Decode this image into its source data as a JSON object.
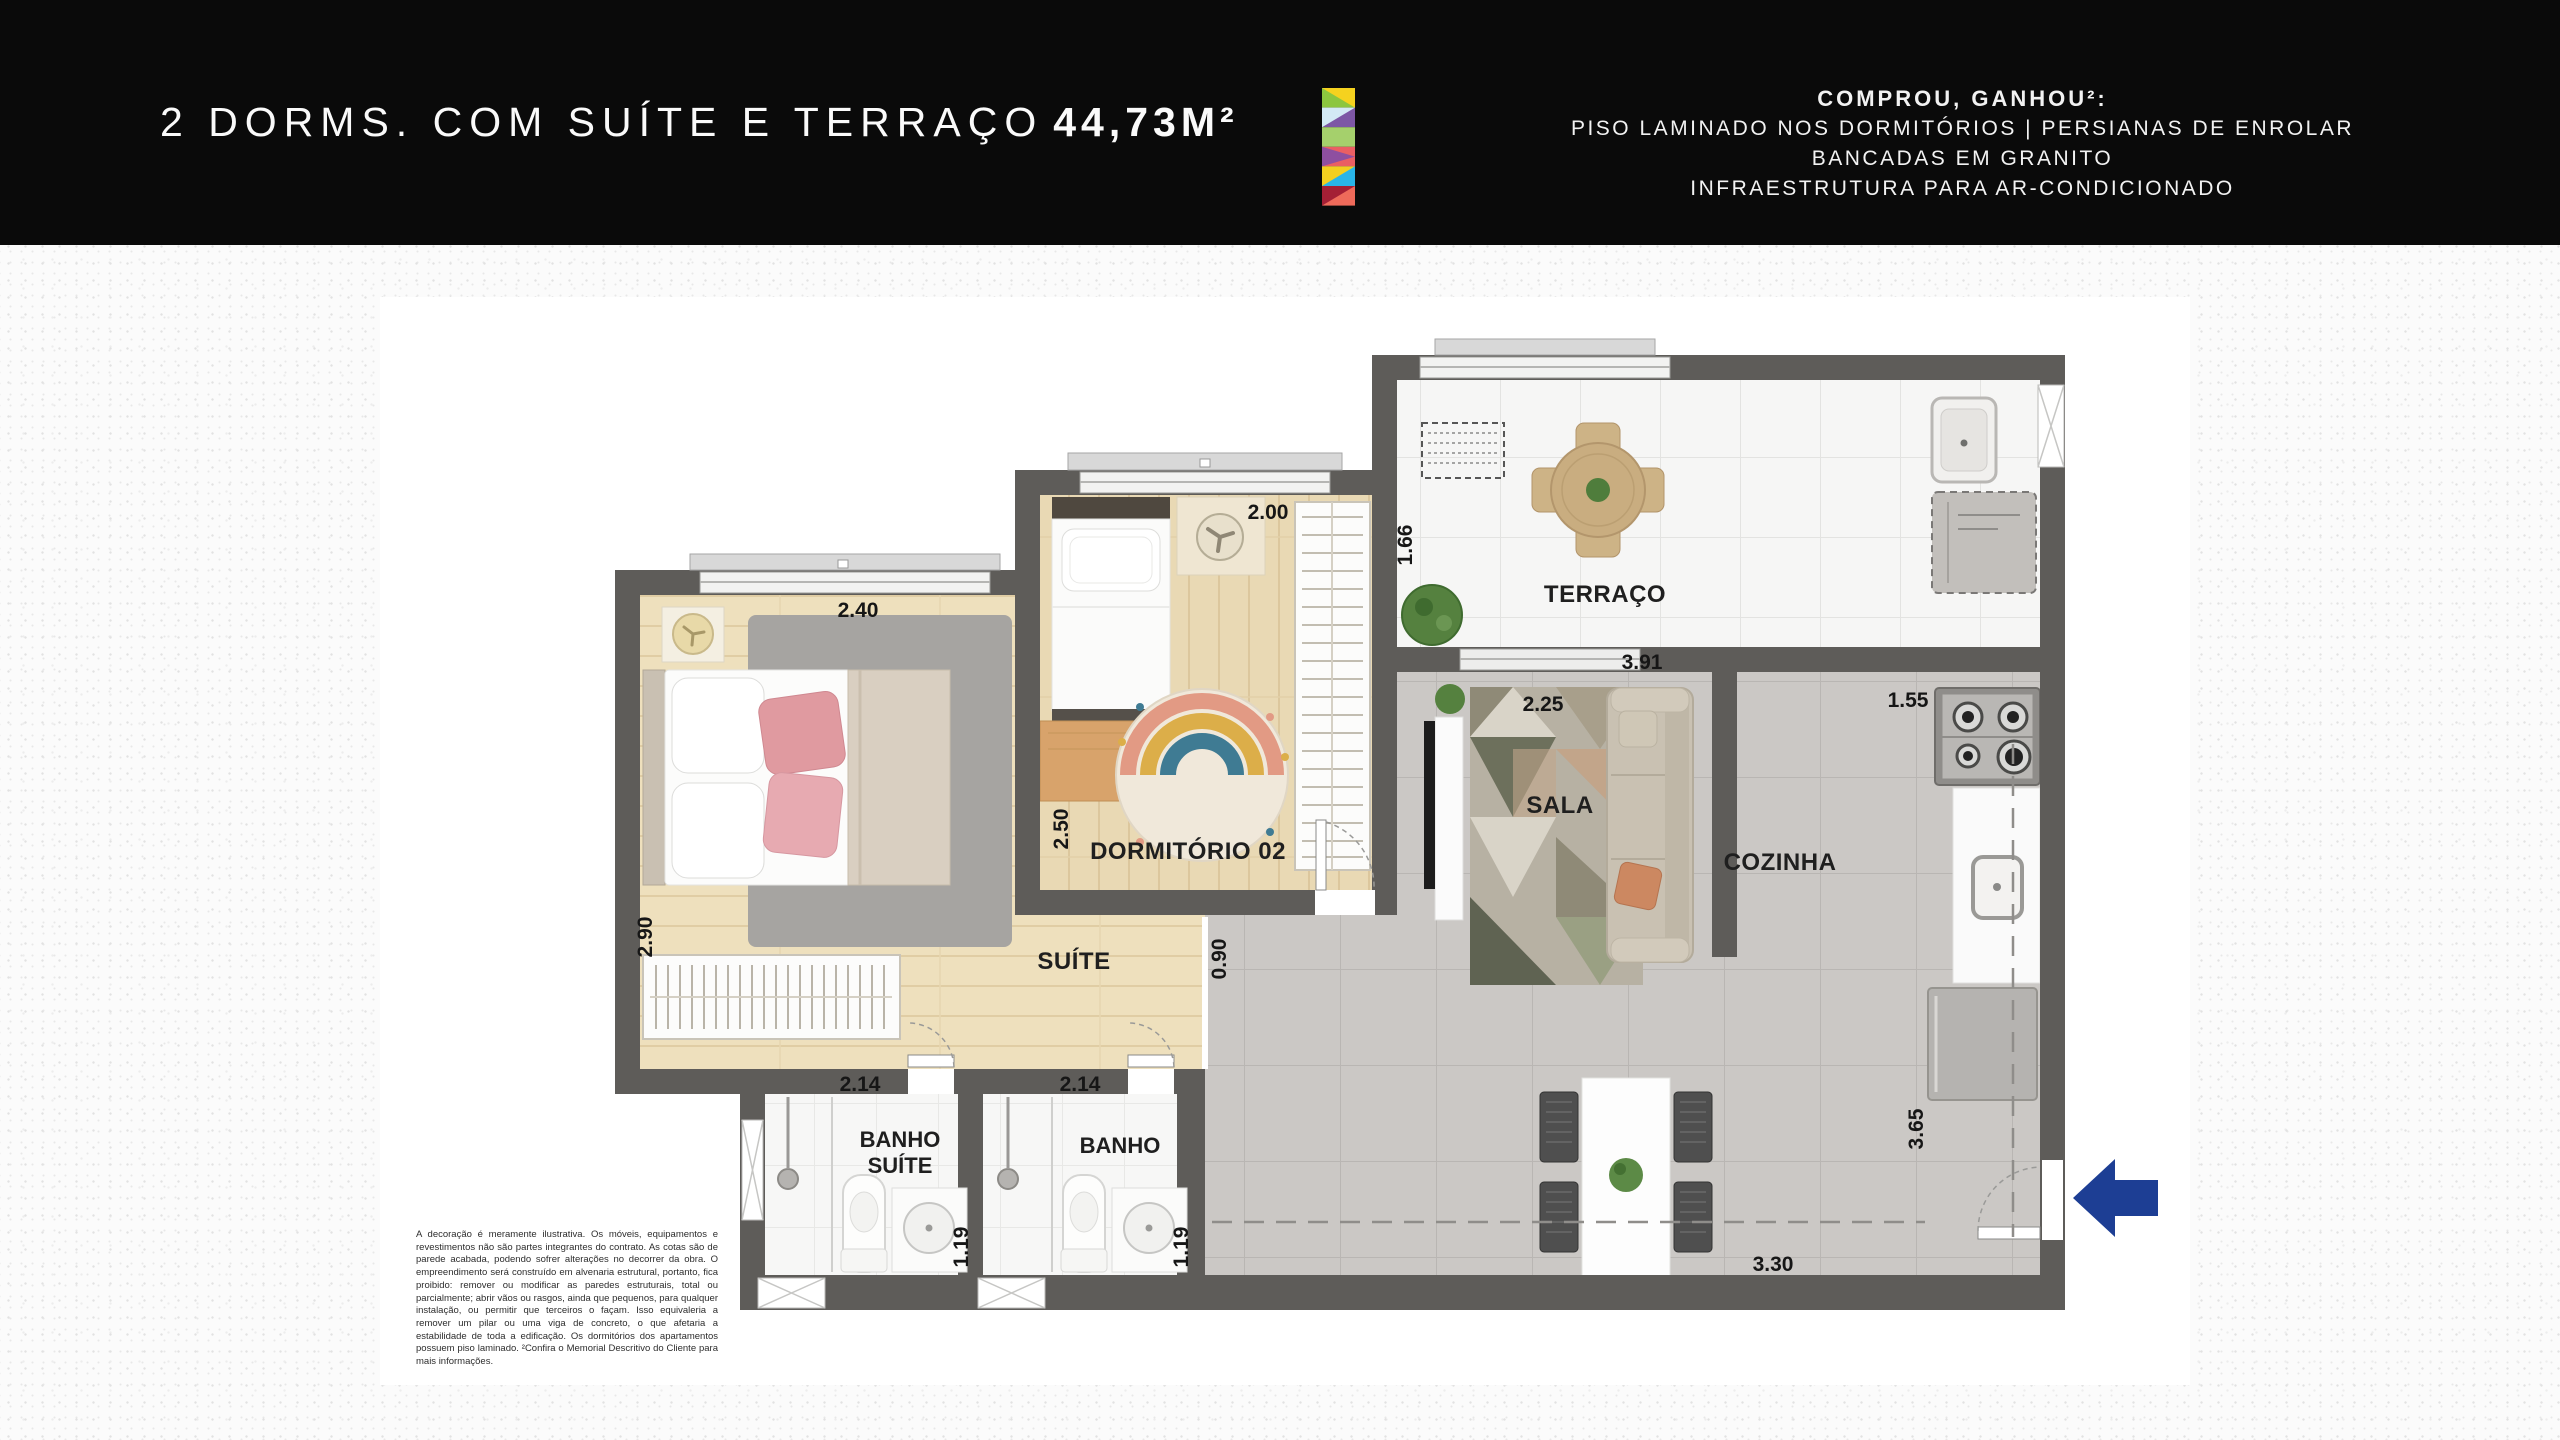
{
  "header": {
    "title": "2 DORMS. COM SUÍTE E TERRAÇO",
    "area": "44,73M²",
    "promo": {
      "heading": "COMPROU, GANHOU²:",
      "line1": "PISO LAMINADO NOS DORMITÓRIOS  |  PERSIANAS DE ENROLAR",
      "line2": "BANCADAS EM GRANITO",
      "line3": "INFRAESTRUTURA PARA AR-CONDICIONADO"
    }
  },
  "plan": {
    "rooms": {
      "terraco": "TERRAÇO",
      "dormitorio2": "DORMITÓRIO 02",
      "suite": "SUÍTE",
      "sala": "SALA",
      "cozinha": "COZINHA",
      "banho_suite_l1": "BANHO",
      "banho_suite_l2": "SUÍTE",
      "banho": "BANHO"
    },
    "dimensions": {
      "suite_width": "2.40",
      "suite_depth": "2.90",
      "dorm2_width": "2.00",
      "dorm2_depth": "2.50",
      "terraco_depth": "1.66",
      "terraco_width": "3.91",
      "sala_width": "2.25",
      "cozinha_width": "1.55",
      "hall_width": "0.90",
      "banho_suite_width": "2.14",
      "banho_suite_depth": "1.19",
      "banho_width": "2.14",
      "banho_depth": "1.19",
      "living_width": "3.30",
      "entry_depth": "3.65"
    },
    "disclaimer": "A decoração é meramente ilustrativa. Os móveis, equipamentos e revestimentos não são partes integrantes do contrato. As cotas são de parede acabada, podendo sofrer alterações no decorrer da obra. O empreendimento será construído em alvenaria estrutural, portanto, fica proibido: remover ou modificar as paredes estruturais, total ou parcialmente; abrir vãos ou rasgos, ainda que pequenos, para qualquer instalação, ou permitir que terceiros o façam. Isso equivaleria a remover um pilar ou uma viga de concreto, o que afetaria a estabilidade de toda a edificação. Os dormitórios dos apartamentos possuem piso laminado. ²Confira o Memorial Descritivo do Cliente para mais informações."
  },
  "colors": {
    "header_bg": "#0a0a0a",
    "wall": "#5e5c59",
    "arrow_blue": "#1d3e94",
    "logo": {
      "sq1a": "#f5d21f",
      "sq1b": "#8cc63f",
      "sq2a": "#d3e9f5",
      "sq2b": "#7d57a5",
      "sq3": "#a5d06c",
      "sq4a": "#ea5f63",
      "sq4b": "#8e4fa0",
      "sq5a": "#f3cf1f",
      "sq5b": "#29b5e8",
      "sq6a": "#a41f35",
      "sq6b": "#ee6a5a"
    }
  }
}
